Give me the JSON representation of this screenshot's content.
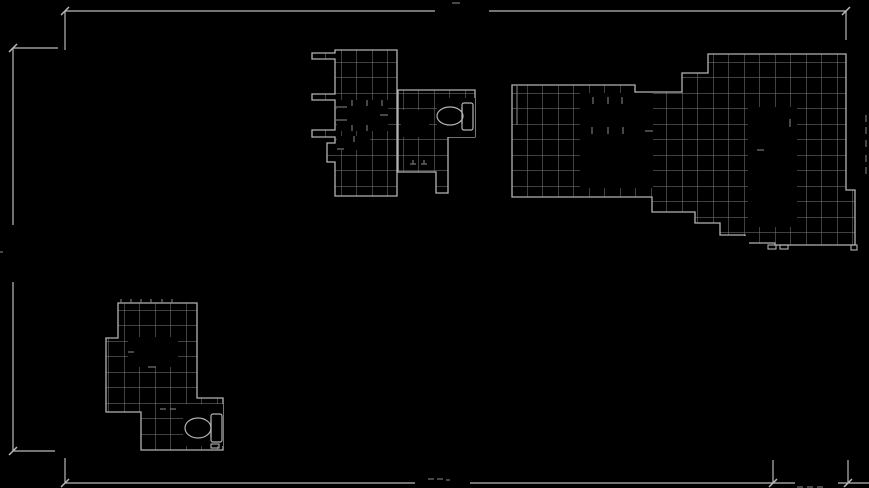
{
  "canvas": {
    "width": 869,
    "height": 488,
    "background": "#000000"
  },
  "colors": {
    "background": "#000000",
    "grid_line": "#7f7f7f",
    "outline": "#b4b4b4",
    "dimension": "#b9b9b9",
    "faint_mark": "#575757"
  },
  "grid": {
    "cell_size": 15.5,
    "line_width": 1
  },
  "clusters": [
    {
      "name": "plan-upper-left-wing",
      "outline": "M335,50 L397,50 L397,196 L335,196 L335,162 L327,162 L327,143 L335,143 L335,137 L312,137 L312,130 L335,130 L335,100 L312,100 L312,94 L335,94 L335,59 L312,59 L312,53 L335,53 Z",
      "rooms": [
        [
          337,
          100,
          51,
          31
        ],
        [
          337,
          136,
          33,
          14
        ]
      ],
      "stubs": [
        [
          352,
          100,
          352,
          106
        ],
        [
          367,
          100,
          367,
          106
        ],
        [
          382,
          100,
          382,
          106
        ],
        [
          336,
          107,
          347,
          107
        ],
        [
          336,
          120,
          347,
          120
        ],
        [
          352,
          125,
          352,
          131
        ],
        [
          367,
          125,
          367,
          131
        ],
        [
          380,
          115,
          388,
          115
        ],
        [
          354,
          136,
          354,
          142
        ],
        [
          337,
          149,
          344,
          149
        ]
      ],
      "tabs": []
    },
    {
      "name": "plan-upper-mid-toilet-room",
      "outline": "M398,90 L475,90 L475,137 L448,137 L448,193 L436,193 L436,172 L398,172 Z",
      "rooms": [
        [
          437,
          98,
          38,
          39
        ],
        [
          401,
          110,
          28,
          27
        ]
      ],
      "stubs": [
        [
          410,
          164,
          416,
          164
        ],
        [
          421,
          164,
          427,
          164
        ],
        [
          413,
          160,
          413,
          164
        ],
        [
          424,
          160,
          424,
          164
        ]
      ],
      "tabs": []
    },
    {
      "name": "plan-upper-right-wing",
      "outline": "M512,85 L635,85 L635,92 L682,92 L682,73 L708,73 L708,54 L846,54 L846,190 L855,190 L855,245 L775,245 L775,243 L745,243 L745,235 L720,235 L720,223 L695,223 L695,212 L652,212 L652,197 L512,197 Z",
      "rooms": [
        [
          580,
          93,
          73,
          95
        ],
        [
          748,
          107,
          49,
          120
        ],
        [
          733,
          236,
          16,
          8
        ]
      ],
      "stubs": [
        [
          593,
          97,
          593,
          104
        ],
        [
          608,
          97,
          608,
          104
        ],
        [
          622,
          97,
          622,
          104
        ],
        [
          592,
          127,
          592,
          134
        ],
        [
          608,
          127,
          608,
          134
        ],
        [
          623,
          127,
          623,
          134
        ],
        [
          645,
          131,
          653,
          131
        ],
        [
          790,
          119,
          790,
          127
        ],
        [
          757,
          150,
          764,
          150
        ],
        [
          517,
          85,
          517,
          125
        ]
      ],
      "tabs": [
        [
          768,
          245,
          8,
          4
        ],
        [
          780,
          245,
          8,
          4
        ],
        [
          851,
          245,
          6,
          5
        ]
      ]
    },
    {
      "name": "plan-lower-left-wing",
      "outline": "M118,303 L197,303 L197,398 L223,398 L223,450 L141,450 L141,412 L106,412 L106,338 L118,338 Z",
      "rooms": [
        [
          128,
          337,
          50,
          30
        ],
        [
          183,
          404,
          40,
          42
        ]
      ],
      "stubs": [
        [
          121,
          299,
          121,
          303
        ],
        [
          131,
          299,
          131,
          303
        ],
        [
          141,
          299,
          141,
          303
        ],
        [
          151,
          299,
          151,
          303
        ],
        [
          162,
          299,
          162,
          303
        ],
        [
          172,
          299,
          172,
          303
        ],
        [
          160,
          409,
          166,
          409
        ],
        [
          170,
          409,
          176,
          409
        ],
        [
          148,
          367,
          156,
          367
        ],
        [
          128,
          352,
          134,
          352
        ]
      ],
      "tabs": [
        [
          211,
          444,
          8,
          4
        ]
      ]
    }
  ],
  "fixtures": [
    {
      "name": "toilet-upper",
      "bowl": {
        "cx": 450,
        "cy": 116,
        "rx": 13,
        "ry": 9
      },
      "tank": {
        "x": 462,
        "y": 103,
        "w": 11,
        "h": 27
      },
      "seat_line": [
        462,
        108,
        462,
        124
      ]
    },
    {
      "name": "toilet-lower",
      "bowl": {
        "cx": 198,
        "cy": 428,
        "rx": 13,
        "ry": 10
      },
      "tank": {
        "x": 211,
        "y": 414,
        "w": 11,
        "h": 28
      },
      "seat_line": [
        211,
        420,
        211,
        437
      ]
    }
  ],
  "dimensions": {
    "lines": [
      [
        65,
        11,
        435,
        11
      ],
      [
        489,
        11,
        846,
        11
      ],
      [
        13,
        48,
        13,
        225
      ],
      [
        13,
        282,
        13,
        451
      ],
      [
        13,
        48,
        58,
        48
      ],
      [
        13,
        451,
        55,
        451
      ],
      [
        65,
        483,
        415,
        483
      ],
      [
        470,
        483,
        795,
        483
      ],
      [
        838,
        483,
        869,
        483
      ],
      [
        65,
        11,
        65,
        50
      ],
      [
        846,
        11,
        846,
        40
      ],
      [
        65,
        458,
        65,
        483
      ],
      [
        773,
        460,
        773,
        483
      ],
      [
        848,
        460,
        848,
        483
      ]
    ],
    "ticks": [
      [
        65,
        11
      ],
      [
        846,
        11
      ],
      [
        13,
        48
      ],
      [
        13,
        451
      ],
      [
        65,
        483
      ],
      [
        773,
        483
      ],
      [
        848,
        483
      ]
    ],
    "faint_marks": [
      [
        452,
        3,
        460,
        3
      ],
      [
        428,
        479,
        434,
        479
      ],
      [
        437,
        479,
        443,
        479
      ],
      [
        446,
        480,
        450,
        480
      ],
      [
        797,
        487,
        803,
        487
      ],
      [
        807,
        487,
        813,
        487
      ],
      [
        817,
        487,
        823,
        487
      ],
      [
        0,
        252,
        3,
        252
      ],
      [
        866,
        115,
        866,
        122
      ],
      [
        866,
        127,
        866,
        134
      ],
      [
        866,
        140,
        866,
        147
      ],
      [
        866,
        155,
        866,
        162
      ],
      [
        866,
        167,
        866,
        174
      ]
    ]
  }
}
